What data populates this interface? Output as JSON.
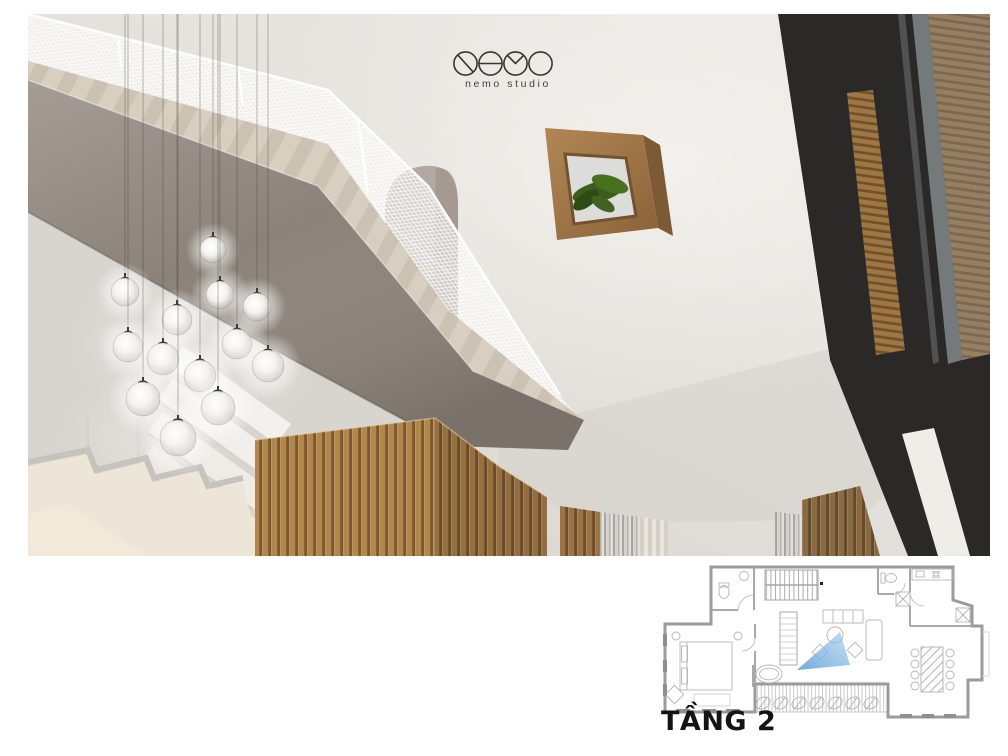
{
  "logo": {
    "brand": "nemo studio",
    "mark": "four-circle NEMO monogram"
  },
  "floor_plan": {
    "label": "TẦNG 2"
  },
  "colors": {
    "wall": "#e4e1dc",
    "concrete": "#8b8279",
    "wood": "#b3874b",
    "wood_dark": "#97703f",
    "wood_panel": "#9b7344",
    "window_frame": "#2b2927",
    "mesh": "#ffffff",
    "plant": "#3c5d1d",
    "view_cone": "#6aa8dc",
    "logo_ink": "#3a352f"
  },
  "lights": {
    "count": 13,
    "positions": [
      {
        "x": 185,
        "y": 236,
        "r": 13
      },
      {
        "x": 97,
        "y": 278,
        "r": 14
      },
      {
        "x": 192,
        "y": 281,
        "r": 14
      },
      {
        "x": 229,
        "y": 293,
        "r": 14
      },
      {
        "x": 149,
        "y": 306,
        "r": 15
      },
      {
        "x": 100,
        "y": 333,
        "r": 15
      },
      {
        "x": 209,
        "y": 330,
        "r": 15
      },
      {
        "x": 240,
        "y": 352,
        "r": 16
      },
      {
        "x": 135,
        "y": 345,
        "r": 16
      },
      {
        "x": 172,
        "y": 362,
        "r": 16
      },
      {
        "x": 115,
        "y": 385,
        "r": 17
      },
      {
        "x": 190,
        "y": 394,
        "r": 17
      },
      {
        "x": 150,
        "y": 424,
        "r": 18
      }
    ]
  },
  "scene": {
    "objects": [
      "mezzanine concrete slab",
      "white perforated mesh railing",
      "arched niche",
      "glass globe pendant lights",
      "wall mounted wooden plant box",
      "timber slat partition wall",
      "black framed glazing with timber slat screen",
      "staircase underside",
      "curtains",
      "second floor plan with view cone"
    ]
  }
}
